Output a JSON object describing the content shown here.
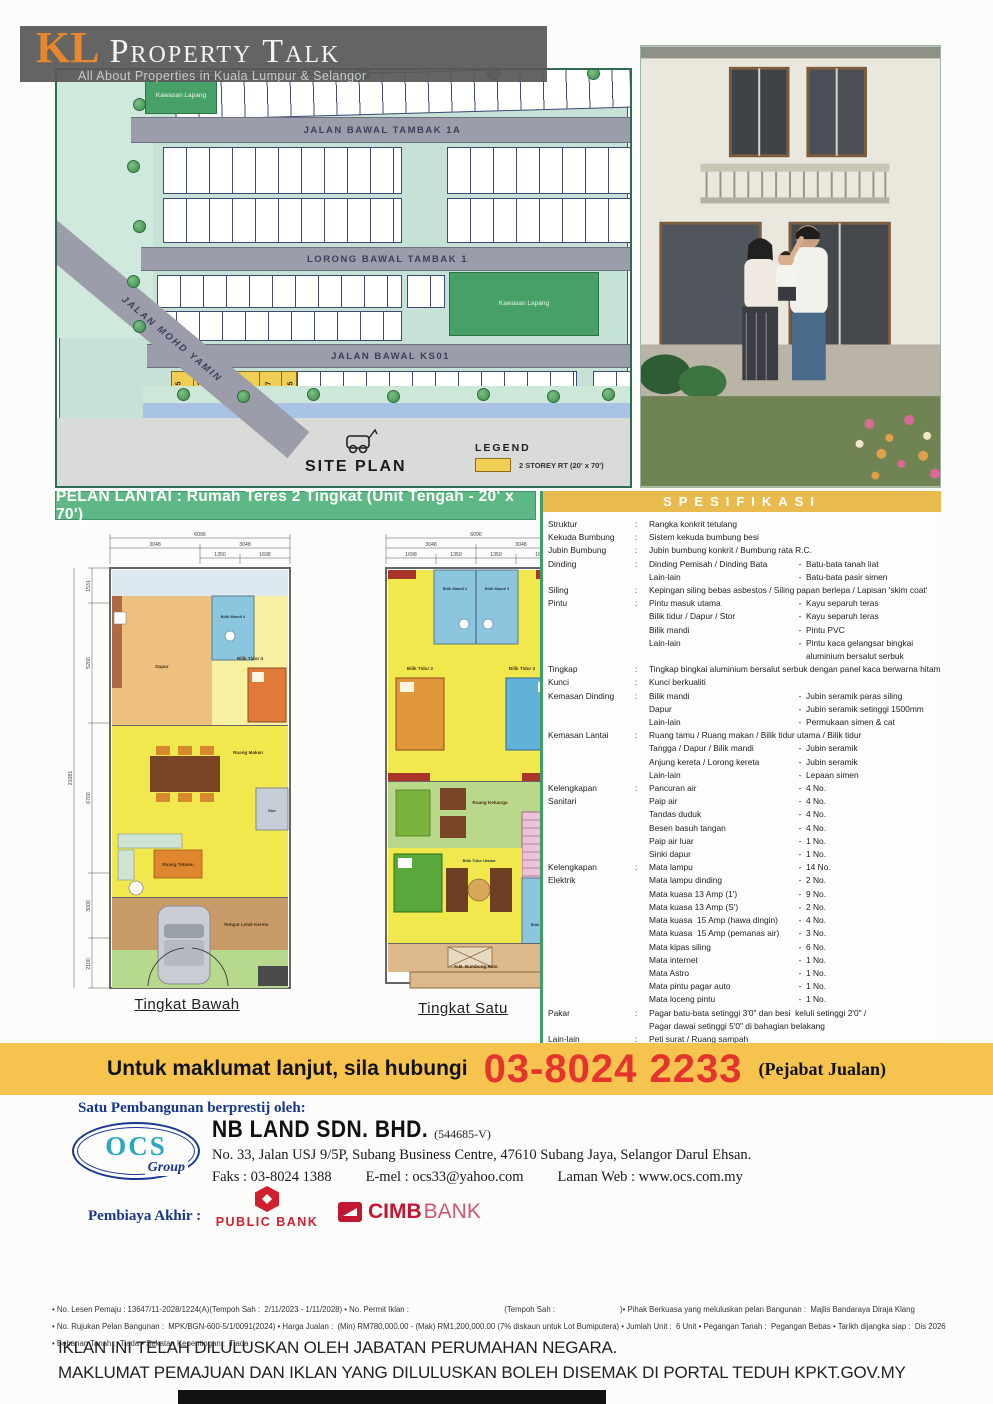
{
  "header": {
    "kl": "KL",
    "name": "Property Talk",
    "tagline": "All About Properties in Kuala Lumpur & Selangor"
  },
  "site_plan": {
    "road1": "JALAN  BAWAL TAMBAK 1A",
    "road2": "LORONG BAWAL TAMBAK 1",
    "road3": "JALAN BAWAL KS01",
    "road4": "JALAN MOHD YAMIN",
    "open_space1": "Kawasan Lapang",
    "open_space2": "Kawasan Lapang",
    "title": "SITE PLAN",
    "legend_title": "LEGEND",
    "legend_item": "2 STOREY RT (20' x 70')",
    "unit_numbers": [
      "195",
      "193",
      "191",
      "189",
      "187",
      "185"
    ]
  },
  "floor_banner": "PELAN LANTAI :  Rumah Teres 2 Tingkat (Unit Tengah - 20' x 70')",
  "floor_plans": {
    "ground": {
      "label": "Tingkat Bawah",
      "rooms": {
        "dapur": "Dapur",
        "bilik_mandi": "Bilik Mandi 4",
        "bilik_tidur4": "Bilik Tidur 4",
        "ruang_makan": "Ruang Makan",
        "stor": "Stor",
        "ruang_tetamu": "Ruang Tetamu",
        "kereta": "Tempat Letak Kereta"
      },
      "dims": {
        "top": [
          "6096",
          "3048",
          "3048",
          "1350",
          "1698"
        ],
        "left": [
          "21081",
          "1531",
          "5200",
          "6700",
          "3000",
          "2100"
        ]
      }
    },
    "first": {
      "label": "Tingkat Satu",
      "rooms": {
        "bm2": "Bilik Mandi 2",
        "bm3": "Bilik Mandi 3",
        "bt2": "Bilik Tidur 2",
        "bt3": "Bilik Tidur 3",
        "keluarga": "Ruang Keluarga",
        "bt_utama": "Bilik Tidur Utama",
        "bm1": "Bilik Mandi 1",
        "bumbung": "N.B. Bumbung Rata"
      },
      "dims": {
        "top": [
          "6096",
          "3048",
          "3048",
          "1698",
          "1350",
          "1350",
          "1698"
        ],
        "right": [
          "16081",
          "7400",
          "6300",
          "3750"
        ]
      }
    }
  },
  "spec": {
    "title": "SPESIFIKASI",
    "rows": [
      {
        "label": "Struktur",
        "colon": ":",
        "desc": "Rangka konkrit tetulang",
        "dash": "",
        "value": ""
      },
      {
        "label": "Kekuda Bumbung",
        "colon": ":",
        "desc": "Sistem kekuda bumbung besi",
        "dash": "",
        "value": ""
      },
      {
        "label": "Jubin Bumbung",
        "colon": ":",
        "desc": "Jubin bumbung konkrit / Bumbung rata R.C.",
        "dash": "",
        "value": ""
      },
      {
        "label": "Dinding",
        "colon": ":",
        "desc": "Dinding Pemisah / Dinding Bata",
        "dash": "-",
        "value": "Batu-bata tanah liat"
      },
      {
        "label": "",
        "colon": "",
        "desc": "Lain-lain",
        "dash": "-",
        "value": "Batu-bata pasir simen"
      },
      {
        "label": "Siling",
        "colon": ":",
        "desc": "Kepingan siling bebas asbestos / Siling papan berlepa / Lapisan 'skim coat'",
        "dash": "",
        "value": ""
      },
      {
        "label": "Pintu",
        "colon": ":",
        "desc": "Pintu masuk utama",
        "dash": "-",
        "value": "Kayu separuh teras"
      },
      {
        "label": "",
        "colon": "",
        "desc": "Bilik tidur / Dapur / Stor",
        "dash": "-",
        "value": "Kayu separuh teras"
      },
      {
        "label": "",
        "colon": "",
        "desc": "Bilik mandi",
        "dash": "-",
        "value": "Pintu PVC"
      },
      {
        "label": "",
        "colon": "",
        "desc": "Lain-lain",
        "dash": "-",
        "value": "Pintu kaca gelangsar bingkai aluminium bersalut serbuk"
      },
      {
        "label": "Tingkap",
        "colon": ":",
        "desc": "Tingkap bingkai aluminium bersalut serbuk dengan panel kaca berwarna hitam",
        "dash": "",
        "value": ""
      },
      {
        "label": "Kunci",
        "colon": ":",
        "desc": "Kunci berkualiti",
        "dash": "",
        "value": ""
      },
      {
        "label": "Kemasan Dinding",
        "colon": ":",
        "desc": "Bilik mandi",
        "dash": "-",
        "value": "Jubin seramik paras siling"
      },
      {
        "label": "",
        "colon": "",
        "desc": "Dapur",
        "dash": "-",
        "value": "Jubin seramik setinggi 1500mm"
      },
      {
        "label": "",
        "colon": "",
        "desc": "Lain-lain",
        "dash": "-",
        "value": "Permukaan simen & cat"
      },
      {
        "label": "Kemasan Lantai",
        "colon": ":",
        "desc": "Ruang tamu / Ruang makan / Bilik tidur utama / Bilik tidur",
        "dash": "",
        "value": ""
      },
      {
        "label": "",
        "colon": "",
        "desc": "Tangga / Dapur / Bilik mandi",
        "dash": "-",
        "value": "Jubin seramik"
      },
      {
        "label": "",
        "colon": "",
        "desc": "Anjung kereta / Lorong kereta",
        "dash": "-",
        "value": "Jubin seramik"
      },
      {
        "label": "",
        "colon": "",
        "desc": "Lain-lain",
        "dash": "-",
        "value": "Lepaan simen"
      },
      {
        "label": "Kelengkapan",
        "colon": ":",
        "desc": "Pancuran air",
        "dash": "-",
        "value": "4 No."
      },
      {
        "label": "Sanitari",
        "colon": "",
        "desc": "Paip air",
        "dash": "-",
        "value": "4 No."
      },
      {
        "label": "",
        "colon": "",
        "desc": "Tandas duduk",
        "dash": "-",
        "value": "4 No."
      },
      {
        "label": "",
        "colon": "",
        "desc": "Besen basuh tangan",
        "dash": "-",
        "value": "4 No."
      },
      {
        "label": "",
        "colon": "",
        "desc": "Paip air luar",
        "dash": "-",
        "value": "1 No."
      },
      {
        "label": "",
        "colon": "",
        "desc": "Sinki dapur",
        "dash": "-",
        "value": "1 No."
      },
      {
        "label": "Kelengkapan",
        "colon": ":",
        "desc": "Mata lampu",
        "dash": "-",
        "value": "14 No."
      },
      {
        "label": "Elektrik",
        "colon": "",
        "desc": "Mata lampu dinding",
        "dash": "-",
        "value": "2 No."
      },
      {
        "label": "",
        "colon": "",
        "desc": "Mata kuasa 13 Amp (1')",
        "dash": "-",
        "value": "9 No."
      },
      {
        "label": "",
        "colon": "",
        "desc": "Mata kuasa 13 Amp (S')",
        "dash": "-",
        "value": "2 No."
      },
      {
        "label": "",
        "colon": "",
        "desc": "Mata kuasa  15 Amp (hawa dingin)",
        "dash": "-",
        "value": "4 No."
      },
      {
        "label": "",
        "colon": "",
        "desc": "Mata kuasa  15 Amp (pemanas air)",
        "dash": "-",
        "value": "3 No."
      },
      {
        "label": "",
        "colon": "",
        "desc": "Mata kipas siling",
        "dash": "-",
        "value": "6 No."
      },
      {
        "label": "",
        "colon": "",
        "desc": "Mata internet",
        "dash": "-",
        "value": "1 No."
      },
      {
        "label": "",
        "colon": "",
        "desc": "Mata Astro",
        "dash": "-",
        "value": "1 No."
      },
      {
        "label": "",
        "colon": "",
        "desc": "Mata pintu pagar auto",
        "dash": "-",
        "value": "1 No."
      },
      {
        "label": "",
        "colon": "",
        "desc": "Mata loceng pintu",
        "dash": "-",
        "value": "1 No."
      },
      {
        "label": "Pakar",
        "colon": ":",
        "desc": "Pagar batu-bata setinggi 3'0\" dan besi  keluli setinggi 2'0\" /",
        "dash": "",
        "value": ""
      },
      {
        "label": "",
        "colon": "",
        "desc": "Pagar dawai setinggi 5'0\" di bahagian belakang",
        "dash": "",
        "value": ""
      },
      {
        "label": "Lain-lain",
        "colon": ":",
        "desc": "Peti surat / Ruang sampah",
        "dash": "",
        "value": ""
      },
      {
        "label": "",
        "colon": "",
        "desc": "Pintu pagar besi keluli",
        "dash": "",
        "value": ""
      }
    ]
  },
  "contact": {
    "prefix": "Untuk maklumat lanjut, sila hubungi",
    "phone": "03-8024 2233",
    "suffix": "(Pejabat Jualan)"
  },
  "developer": {
    "tagline": "Satu Pembangunan berprestij oleh:",
    "logo_ocs": "OCS",
    "logo_group": "Group",
    "company": "NB LAND SDN. BHD.",
    "reg": "(544685-V)",
    "address": "No. 33, Jalan USJ 9/5P, Subang Business Centre, 47610 Subang Jaya, Selangor Darul Ehsan.",
    "fax": "Faks : 03-8024 1388",
    "email": "E-mel :  ocs33@yahoo.com",
    "web": "Laman Web :  www.ocs.com.my"
  },
  "banks": {
    "label": "Pembiaya Akhir  :",
    "public_bank": "PUBLIC BANK",
    "cimb_bold": "CIMB",
    "cimb_light": "BANK"
  },
  "legal": {
    "lines": [
      "• No. Lesen Pemaju : 13647/11-2028/1224(A)(Tempoh Sah :  2/11/2023 - 1/11/2028) • No. Permit Iklan :                                            (Tempoh Sah :                              )• Pihak Berkuasa yang meluluskan pelan Bangunan :  Majlis Bandaraya Diraja Klang",
      "• No. Rujukan Pelan Bangunan :  MPK/BGN-600-5/1/0091(2024) • Harga Jualan :  (Min) RM780,000.00 - (Mak) RM1,200,000.00 (7% diskaun untuk Lot Bumiputera) • Jumlah Unit :  6 Unit • Pegangan Tanah :  Pegangan Bebas • Tarikh dijangka siap :  Dis 2026",
      "• Bebanan Tanah :  Tiada • Sekatan Kepentingan :  Tiada"
    ]
  },
  "approval": {
    "line1": "IKLAN INI TELAH DILULUSKAN OLEH JABATAN PERUMAHAN NEGARA.",
    "line2": "MAKLUMAT PEMAJUAN DAN IKLAN YANG DILULUSKAN BOLEH DISEMAK DI PORTAL TEDUH KPKT.GOV.MY"
  },
  "colors": {
    "banner_green": "#5eb886",
    "spec_gold": "#e9ba4e",
    "contact_yellow": "#f6c44e",
    "phone_red": "#e5332e",
    "brand_blue": "#18368f",
    "cimb_red": "#c21731",
    "public_bank_red": "#d01f2f"
  }
}
